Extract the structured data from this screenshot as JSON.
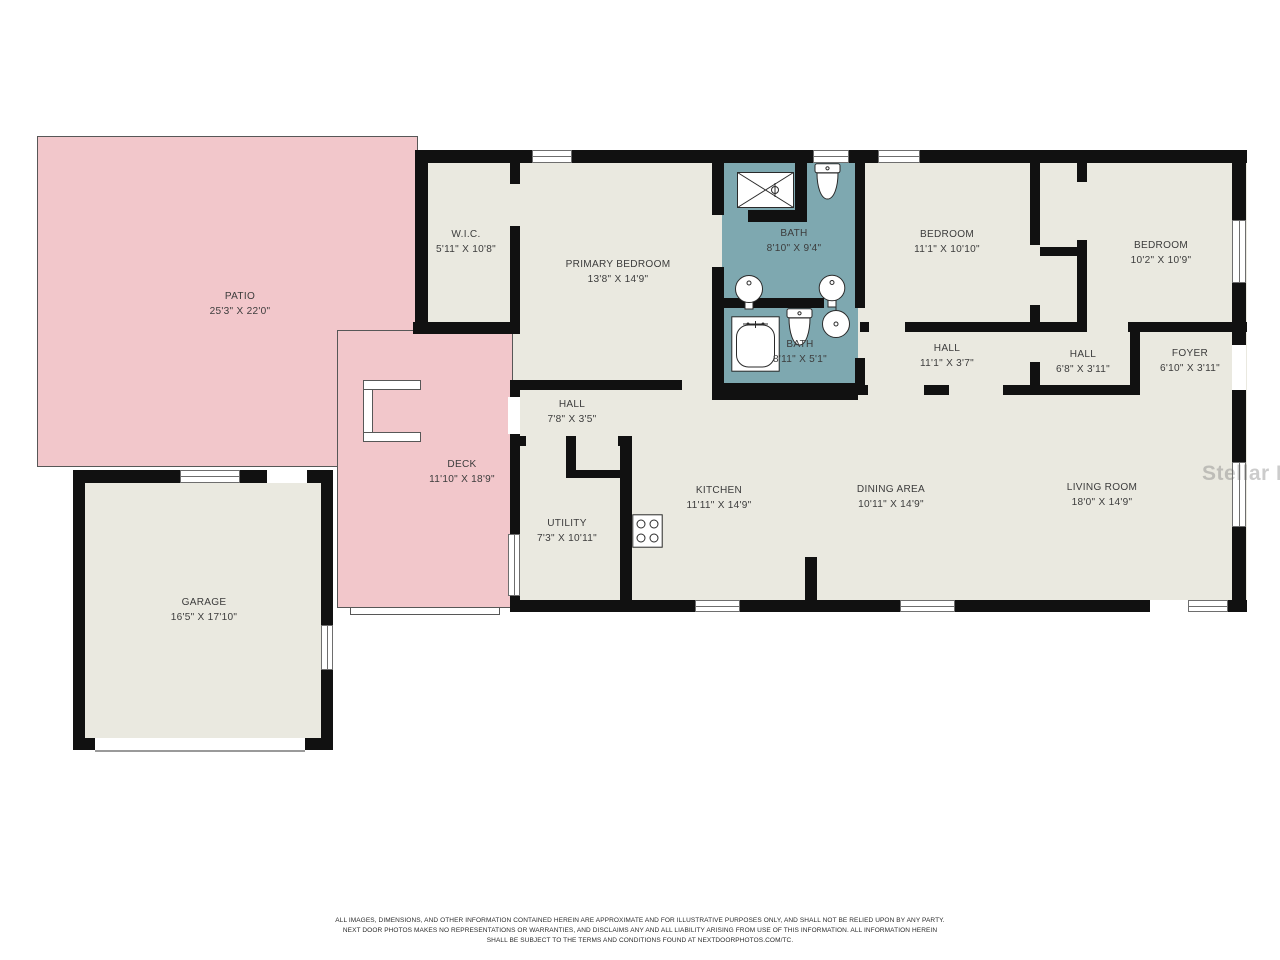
{
  "colors": {
    "patio_deck_fill": "#F2C7CB",
    "bath_fill": "#7EA8B0",
    "room_fill": "#EAE9E0",
    "wall": "#111111",
    "label_text": "#3C3C3C"
  },
  "rooms": {
    "patio": {
      "name": "PATIO",
      "dims": "25'3\" X 22'0\""
    },
    "deck": {
      "name": "DECK",
      "dims": "11'10\" X 18'9\""
    },
    "wic": {
      "name": "W.I.C.",
      "dims": "5'11\" X 10'8\""
    },
    "primary_bedroom": {
      "name": "PRIMARY BEDROOM",
      "dims": "13'8\" X 14'9\""
    },
    "bath_main": {
      "name": "BATH",
      "dims": "8'10\" X 9'4\""
    },
    "bath_second": {
      "name": "BATH",
      "dims": "8'11\" X 5'1\""
    },
    "bedroom_middle": {
      "name": "BEDROOM",
      "dims": "11'1\" X 10'10\""
    },
    "bedroom_right": {
      "name": "BEDROOM",
      "dims": "10'2\" X 10'9\""
    },
    "hall_bedrooms": {
      "name": "HALL",
      "dims": "11'1\" X 3'7\""
    },
    "hall_foyer": {
      "name": "HALL",
      "dims": "6'8\" X 3'11\""
    },
    "foyer": {
      "name": "FOYER",
      "dims": "6'10\" X 3'11\""
    },
    "hall_rear": {
      "name": "HALL",
      "dims": "7'8\" X 3'5\""
    },
    "utility": {
      "name": "UTILITY",
      "dims": "7'3\" X 10'11\""
    },
    "kitchen": {
      "name": "KITCHEN",
      "dims": "11'11\" X 14'9\""
    },
    "dining": {
      "name": "DINING AREA",
      "dims": "10'11\" X 14'9\""
    },
    "living": {
      "name": "LIVING ROOM",
      "dims": "18'0\" X 14'9\""
    },
    "garage": {
      "name": "GARAGE",
      "dims": "16'5\" X 17'10\""
    }
  },
  "fixtures": [
    "shower",
    "toilet",
    "pedestal-sink",
    "round-sink",
    "bathtub",
    "stove"
  ],
  "watermark": "Stellar MLS",
  "disclaimer": {
    "lines": [
      "ALL IMAGES, DIMENSIONS, AND OTHER INFORMATION CONTAINED HEREIN ARE APPROXIMATE AND FOR ILLUSTRATIVE PURPOSES ONLY, AND SHALL NOT BE RELIED UPON BY ANY PARTY.",
      "NEXT DOOR PHOTOS MAKES NO REPRESENTATIONS OR WARRANTIES, AND DISCLAIMS ANY AND ALL LIABILITY ARISING FROM USE OF THIS INFORMATION. ALL INFORMATION HEREIN",
      "SHALL BE SUBJECT TO THE TERMS AND CONDITIONS FOUND AT NEXTDOORPHOTOS.COM/TC."
    ]
  }
}
